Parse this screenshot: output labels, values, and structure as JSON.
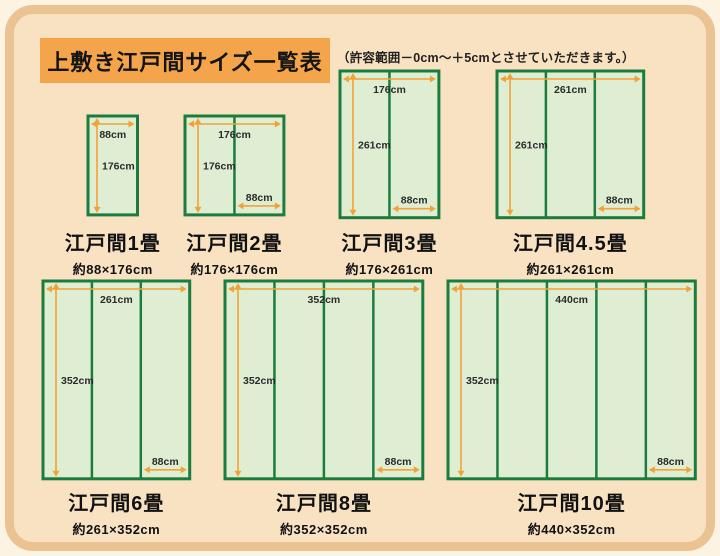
{
  "page": {
    "title": "上敷き江戸間サイズ一覧表",
    "note": "（許容範囲－0cm～＋5cmとさせていただきます。）",
    "colors": {
      "page_bg": "#FCF3E2",
      "frame_border": "#EBC392",
      "panel_bg": "#F8E2C2",
      "title_bg": "#F4A54B",
      "mat_fill": "#DFEED3",
      "mat_border": "#1C7C3E",
      "arrow": "#F2A237",
      "text": "#1A1A1A"
    }
  },
  "diagrams": [
    {
      "name": "edoma-1",
      "label": "江戸間1畳",
      "size_label": "約88×176cm",
      "width_cm": 88,
      "height_cm": 176,
      "columns": 1,
      "dim_top": "88cm",
      "dim_left": "176cm",
      "dim_bottom": null,
      "pos": {
        "x": 88,
        "y": 116,
        "label_y": 227
      }
    },
    {
      "name": "edoma-2",
      "label": "江戸間2畳",
      "size_label": "約176×176cm",
      "width_cm": 176,
      "height_cm": 176,
      "columns": 2,
      "dim_top": "176cm",
      "dim_left": "176cm",
      "dim_bottom": "88cm",
      "pos": {
        "x": 185,
        "y": 116,
        "label_y": 227
      }
    },
    {
      "name": "edoma-3",
      "label": "江戸間3畳",
      "size_label": "約176×261cm",
      "width_cm": 176,
      "height_cm": 261,
      "columns": 2,
      "dim_top": "176cm",
      "dim_left": "261cm",
      "dim_bottom": "88cm",
      "pos": {
        "x": 340,
        "y": 71,
        "label_y": 227
      }
    },
    {
      "name": "edoma-4-5",
      "label": "江戸間4.5畳",
      "size_label": "約261×261cm",
      "width_cm": 261,
      "height_cm": 261,
      "columns": 3,
      "dim_top": "261cm",
      "dim_left": "261cm",
      "dim_bottom": "88cm",
      "pos": {
        "x": 497,
        "y": 71,
        "label_y": 227
      }
    },
    {
      "name": "edoma-6",
      "label": "江戸間6畳",
      "size_label": "約261×352cm",
      "width_cm": 261,
      "height_cm": 352,
      "columns": 3,
      "dim_top": "261cm",
      "dim_left": "352cm",
      "dim_bottom": "88cm",
      "pos": {
        "x": 43,
        "y": 281,
        "label_y": 487
      }
    },
    {
      "name": "edoma-8",
      "label": "江戸間8畳",
      "size_label": "約352×352cm",
      "width_cm": 352,
      "height_cm": 352,
      "columns": 4,
      "dim_top": "352cm",
      "dim_left": "352cm",
      "dim_bottom": "88cm",
      "pos": {
        "x": 225,
        "y": 281,
        "label_y": 487
      }
    },
    {
      "name": "edoma-10",
      "label": "江戸間10畳",
      "size_label": "約440×352cm",
      "width_cm": 440,
      "height_cm": 352,
      "columns": 5,
      "dim_top": "440cm",
      "dim_left": "352cm",
      "dim_bottom": "88cm",
      "pos": {
        "x": 448,
        "y": 281,
        "label_y": 487
      }
    }
  ]
}
